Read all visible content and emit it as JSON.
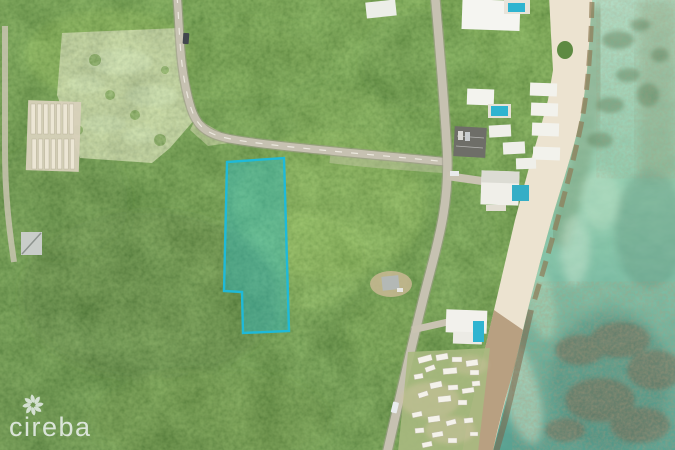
{
  "watermark": {
    "logo_text": "cireba",
    "logo_color": "rgba(233,239,236,0.88)",
    "icon": "pinwheel-flower-icon"
  },
  "parcel_overlay": {
    "polygon_points": "227,162 284,158 289,331 243,333 242,292 224,291",
    "fill_color": "rgba(32,188,216,0.38)",
    "outline_color": "#1fbad8",
    "outline_width": "2.4"
  },
  "scene": {
    "palette": {
      "forest_dark": "#3e6526",
      "forest_mid": "#4f7a2e",
      "forest_light": "#649238",
      "water_shallow": "#b7dcc1",
      "water_mid": "#8fc9a8",
      "water_deep": "#4e9787",
      "sand": "#ece3d0",
      "road": "#c6c1b1",
      "cleared_land": "#d6cdb5",
      "pool_teal": "#2fb4d0"
    }
  }
}
